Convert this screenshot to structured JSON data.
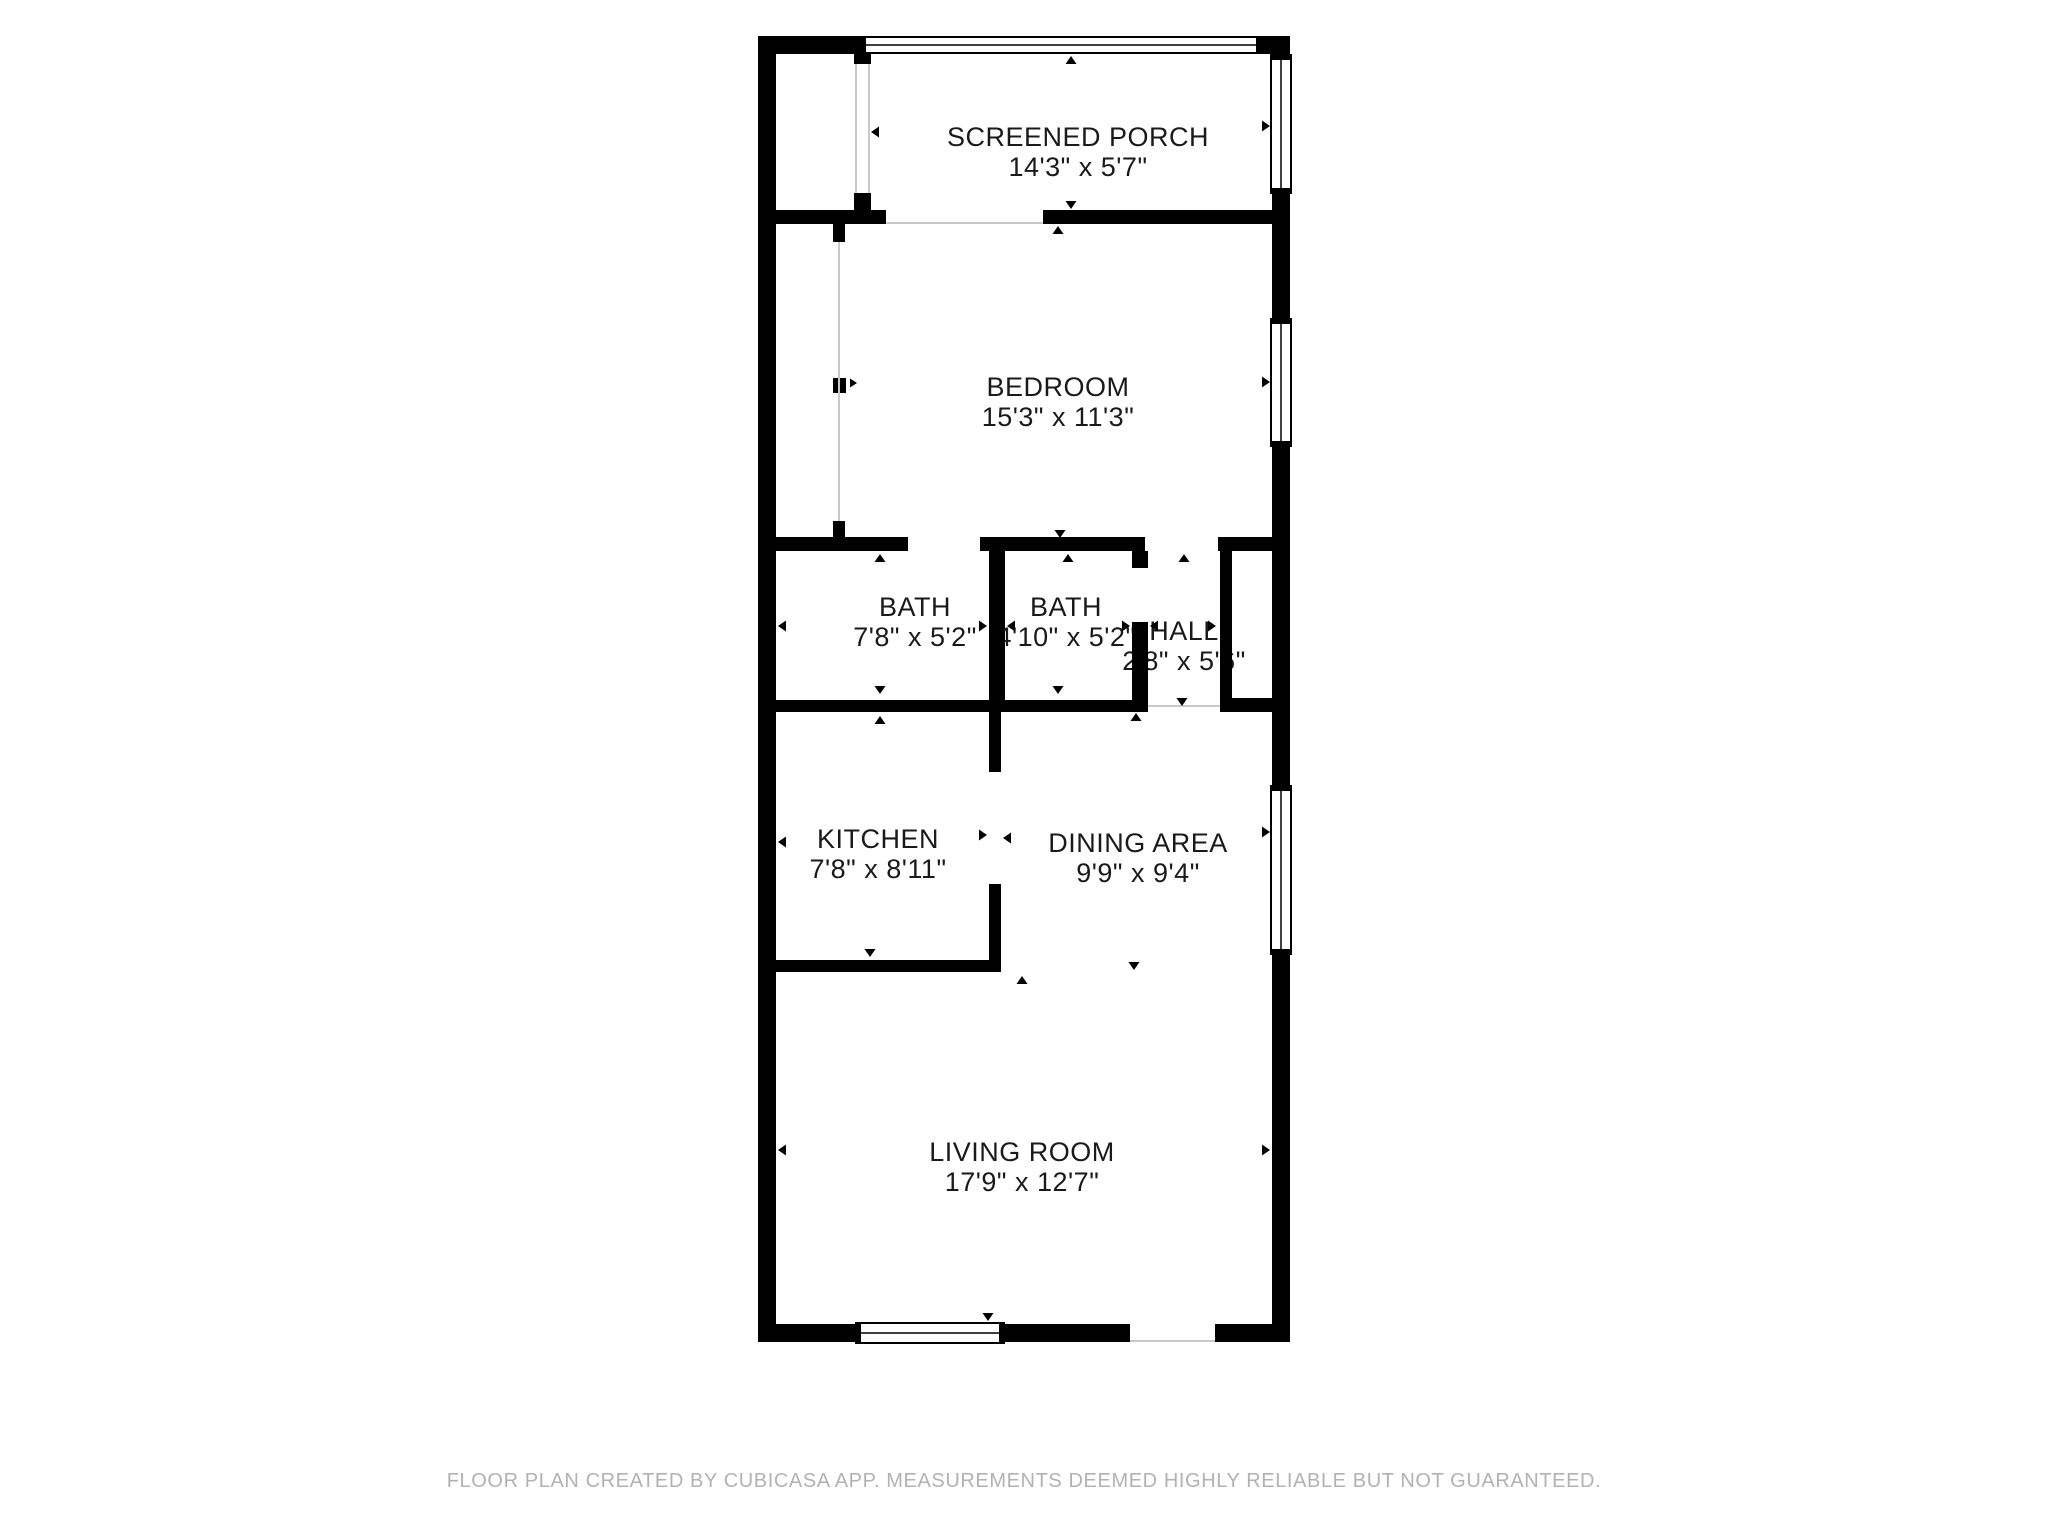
{
  "colors": {
    "background": "#ffffff",
    "wall": "#000000",
    "label_text": "#1a1a1a",
    "footer_text": "#b2b2b2",
    "open_boundary_line": "#c9c9c9"
  },
  "rooms": [
    {
      "id": "screened-porch",
      "name": "SCREENED PORCH",
      "dimensions": "14'3\" x 5'7\""
    },
    {
      "id": "bedroom",
      "name": "BEDROOM",
      "dimensions": "15'3\" x 11'3\""
    },
    {
      "id": "bath-1",
      "name": "BATH",
      "dimensions": "7'8\" x 5'2\""
    },
    {
      "id": "bath-2",
      "name": "BATH",
      "dimensions": "4'10\" x 5'2\""
    },
    {
      "id": "hall",
      "name": "HALL",
      "dimensions": "2'8\" x 5'6\""
    },
    {
      "id": "kitchen",
      "name": "KITCHEN",
      "dimensions": "7'8\" x 8'11\""
    },
    {
      "id": "dining-area",
      "name": "DINING AREA",
      "dimensions": "9'9\" x 9'4\""
    },
    {
      "id": "living-room",
      "name": "LIVING ROOM",
      "dimensions": "17'9\" x 12'7\""
    }
  ],
  "footer": {
    "disclaimer": "FLOOR PLAN CREATED BY CUBICASA APP. MEASUREMENTS DEEMED HIGHLY RELIABLE BUT NOT GUARANTEED."
  }
}
